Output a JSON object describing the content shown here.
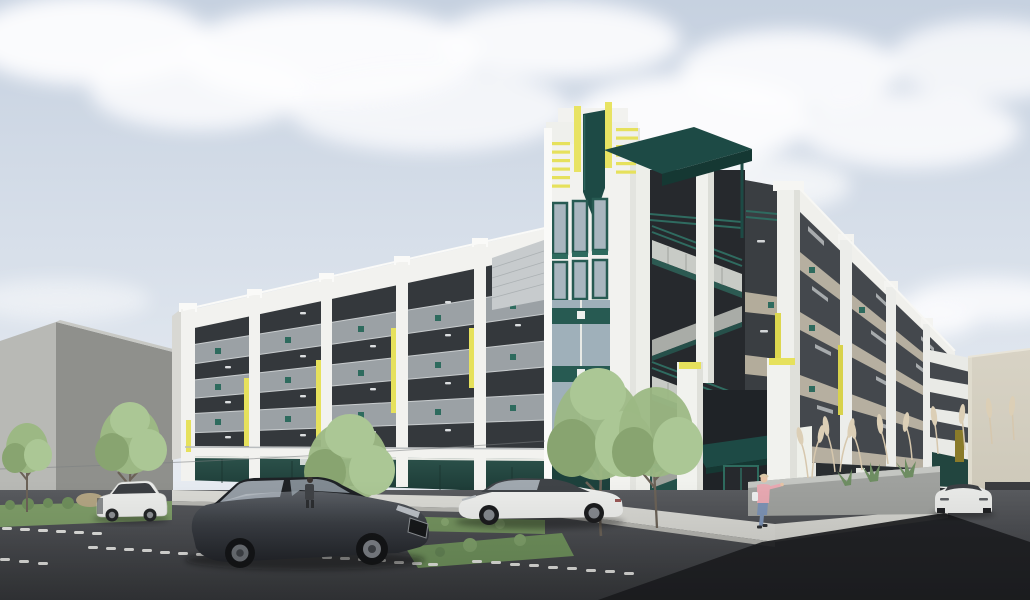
{
  "meta": {
    "type": "architectural-rendering",
    "subject": "Street-corner daytime rendering of a four-story parking garage with art-deco tower, open stair, teal and yellow accents",
    "sky": "partly cloudy"
  },
  "counts": {
    "garage_levels": 4,
    "vehicles": 4,
    "people": 2,
    "street_trees": 5
  },
  "objects": [
    {
      "name": "parking-garage",
      "desc": "white precast structure, gray spandrels, teal square accents, yellow vertical fins"
    },
    {
      "name": "art-deco-tower",
      "desc": "stepped crown, yellow louvers and blades, dark teal shield"
    },
    {
      "name": "open-stair-tower",
      "desc": "dark teal flat canopy, white posts, switchback concrete stairs, teal railings"
    },
    {
      "name": "ground-storefront",
      "desc": "dark teal glazing band with white piers"
    },
    {
      "name": "corner-entrance",
      "desc": "teal awnings over glass door"
    },
    {
      "name": "dark-wagon",
      "desc": "charcoal station wagon parked in foreground"
    },
    {
      "name": "white-suv",
      "desc": "white SUV parked at left"
    },
    {
      "name": "white-sedan",
      "desc": "white fastback sedan at curb"
    },
    {
      "name": "white-car-right",
      "desc": "white car at garage ramp, front view"
    },
    {
      "name": "pedestrian-pink",
      "desc": "person in pink top and jeans at corner"
    },
    {
      "name": "pedestrian-dark",
      "desc": "person in dark clothes on sidewalk"
    },
    {
      "name": "background-buildings",
      "desc": "gray massing block left, beige block right"
    },
    {
      "name": "parking-lot",
      "desc": "asphalt with dashed white stall markings"
    }
  ],
  "palette": {
    "sky_top": "#c6d1e0",
    "sky_bottom": "#eef1f5",
    "cloud": "#fdfdfe",
    "white_concrete": "#f2f2ef",
    "white_shade": "#dddfd9",
    "spandrel_gray": "#9ba1a5",
    "opening_dark": "#34383c",
    "teal": "#2e6b5e",
    "teal_dark": "#1d4a45",
    "glass_teal": "#24473f",
    "yellow": "#e6e15c",
    "yellow_dark": "#cfc84a",
    "tan": "#b6afa0",
    "east_dark": "#44484d",
    "beige": "#cfcaba",
    "bg_light": "#b8b9b5",
    "bg_shade": "#8f908c",
    "asphalt": "#4a4c50",
    "deep_shadow": "#1f2023",
    "sidewalk": "#dadad5",
    "curb": "#b7b7b2",
    "grass": "#7e9d68",
    "foliage": "#9cb884",
    "foliage_light": "#abc795",
    "foliage_dark": "#88a470",
    "trunk": "#6b6257",
    "pampas": "#d8cab0",
    "planter": "#9fa19e",
    "car_dark": "#34373c",
    "car_white": "#ecedeb",
    "glass_dark": "#3b3e42"
  }
}
